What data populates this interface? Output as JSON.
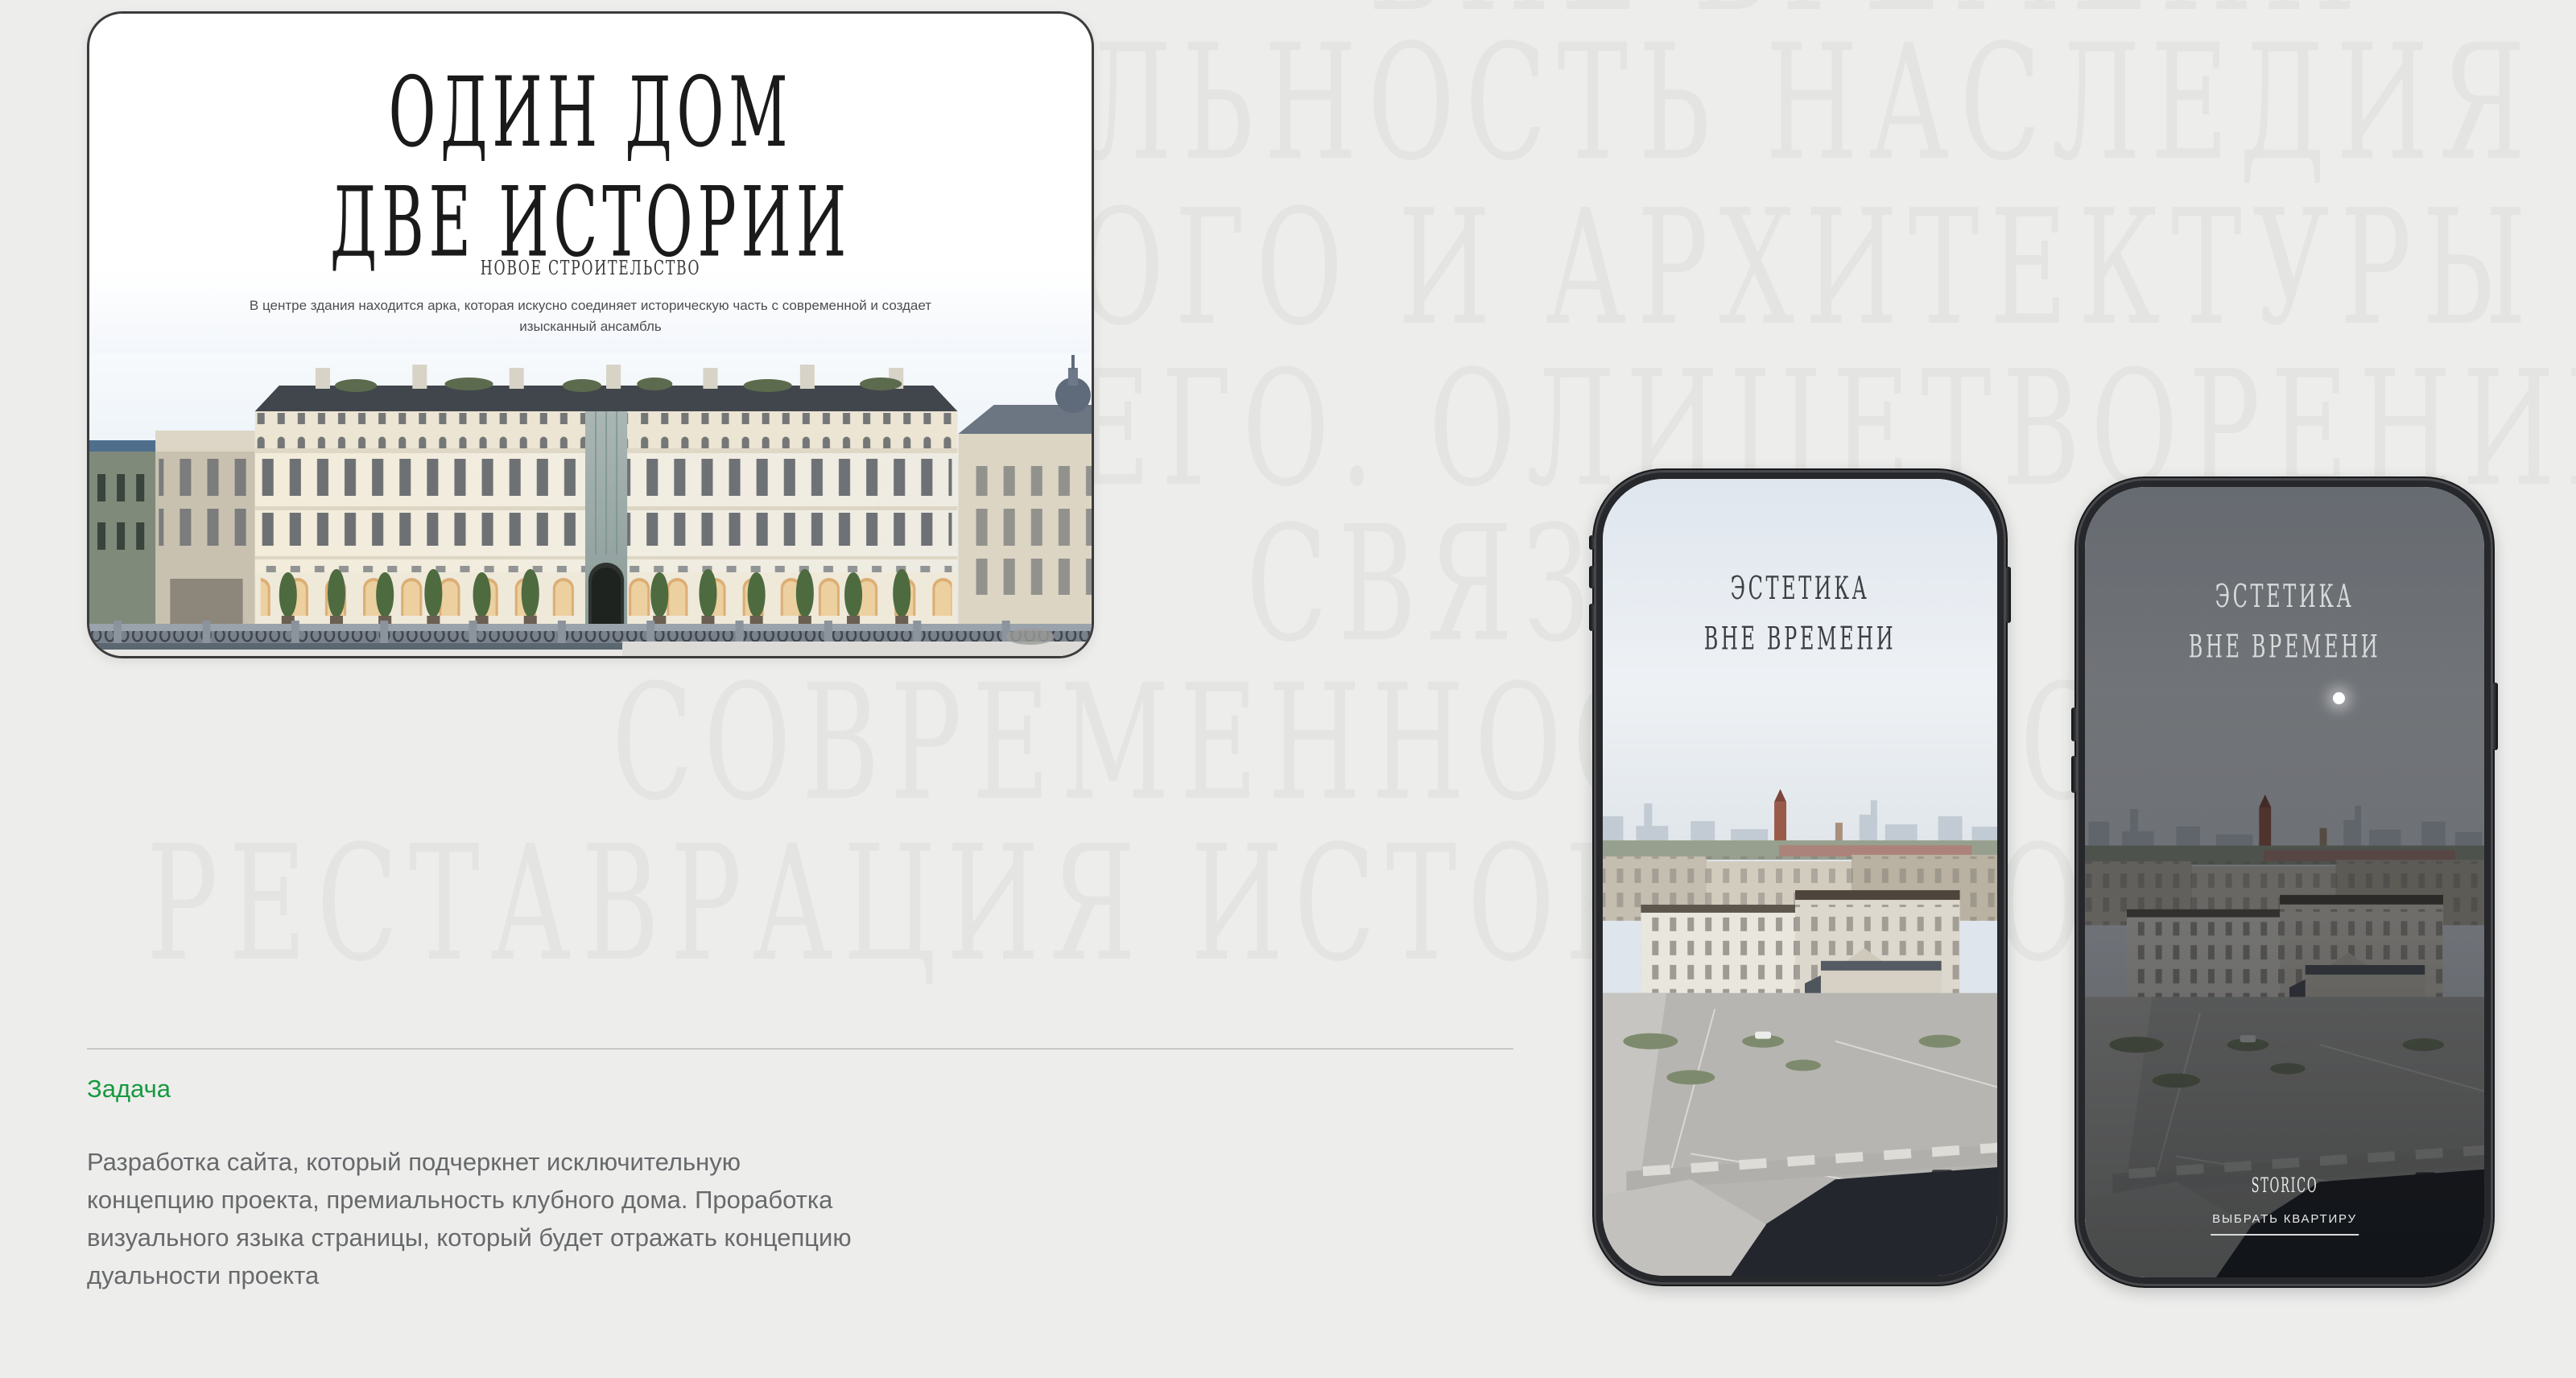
{
  "page": {
    "background_color": "#ededec",
    "watermark_color": "#e4e4e2"
  },
  "watermark": {
    "lines": [
      "ВНЕ ВРЕМЕНИ",
      "ЛЬНОСТЬ НАСЛЕДИЯ",
      "ОГО И АРХИТЕКТУРЫ",
      "ЕГО. ОЛИЦЕТВОРЕНИЕ",
      "СВЯЗИ",
      "СОВРЕМЕННОСТЬ И СТИЛЬ",
      "РЕСТАВРАЦИЯ ИСТОРИИ ДОМА"
    ]
  },
  "hero_card": {
    "title_line1": "ОДИН ДОМ",
    "title_line2": "ДВЕ ИСТОРИИ",
    "badge": "НОВОЕ СТРОИТЕЛЬСТВО",
    "description_line1": "В центре здания находится арка, которая искусно соединяет историческую часть с современной и создает",
    "description_line2": "изысканный ансамбль",
    "illustration": "riverfront-classical-building-render"
  },
  "task": {
    "heading": "Задача",
    "heading_color": "#17993f",
    "body_lines": [
      "Разработка сайта, который подчеркнет исключительную",
      "концепцию проекта, премиальность клубного дома. Проработка",
      "визуального языка страницы, который будет отражать концепцию",
      "дуальности проекта"
    ]
  },
  "phones": {
    "screen_title_line1": "ЭСТЕТИКА",
    "screen_title_line2": "ВНЕ ВРЕМЕНИ",
    "logo": "STORICO",
    "cta_label": "ВЫБРАТЬ КВАРТИРУ",
    "illustration": "aerial-city-embankment-render"
  }
}
